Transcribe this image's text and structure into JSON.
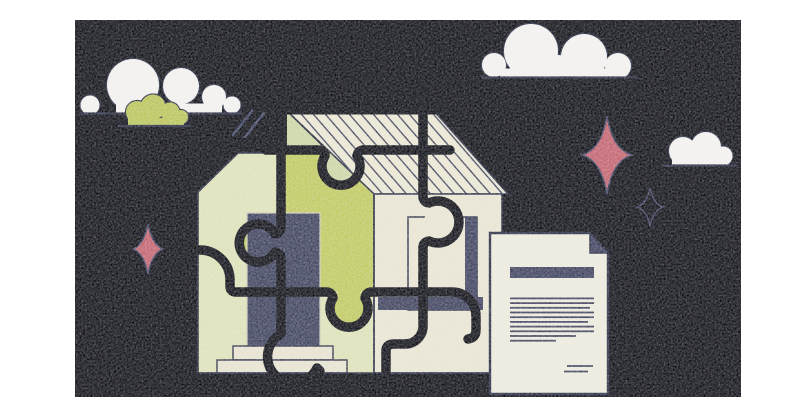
{
  "scene": {
    "description": "Illustration of a house built from interlocking puzzle pieces on a black night background, with clouds, sparkle stars, and a signed paper document",
    "canvas": {
      "x": 75,
      "y": 20,
      "width": 666,
      "height": 377
    }
  },
  "colors": {
    "page_bg": "#ffffff",
    "canvas_bg": "#0b0c11",
    "puzzle_line": "#0b0c12",
    "outline": "#262a40",
    "wall_pale": "#dee2b6",
    "gable_pale": "#cbd6a3",
    "olive": "#bfc95c",
    "roof_cream": "#ebe7d2",
    "wall_cream": "#e9e5d1",
    "hatch_line": "#3f435a",
    "navy": "#3a3e59",
    "step_cream": "#e7e3cf",
    "cloud_white": "#f3f2ee",
    "cloud_olive": "#b9c456",
    "star_red": "#c2606b",
    "star_outline": "#3e4464",
    "paper": "#edebdc",
    "door_edge": "#cfccb8"
  },
  "clouds": [
    {
      "name": "cloud-top-left",
      "color_key": "cloud_white",
      "base": {
        "x1": 80,
        "x2": 242,
        "y": 113.5
      },
      "strip": {
        "x1": 116,
        "x2": 222,
        "h": 10
      },
      "lobes": [
        [
          90,
          105,
          9.5
        ],
        [
          133,
          85,
          26
        ],
        [
          181,
          86,
          18
        ],
        [
          214,
          97,
          12
        ],
        [
          232,
          105,
          8.5
        ]
      ]
    },
    {
      "name": "cloud-olive",
      "color_key": "cloud_olive",
      "base": {
        "x1": 118,
        "x2": 190,
        "y": 126
      },
      "strip": {
        "x1": 128,
        "x2": 184,
        "h": 8
      },
      "lobes": [
        [
          137,
          112,
          11
        ],
        [
          153,
          107,
          12.5
        ],
        [
          170,
          112,
          9.5
        ],
        [
          181,
          117,
          7
        ]
      ]
    },
    {
      "name": "cloud-top-right",
      "color_key": "cloud_white",
      "base": {
        "x1": 482,
        "x2": 637,
        "y": 77.5
      },
      "strip": {
        "x1": 500,
        "x2": 625,
        "h": 9
      },
      "lobes": [
        [
          494,
          65,
          12
        ],
        [
          531,
          51,
          27
        ],
        [
          558,
          68,
          13
        ],
        [
          584,
          57,
          23
        ],
        [
          618,
          66,
          13
        ]
      ]
    },
    {
      "name": "cloud-small-right",
      "color_key": "cloud_white",
      "base": {
        "x1": 663,
        "x2": 737,
        "y": 165.5
      },
      "strip": {
        "x1": 672,
        "x2": 728,
        "h": 8
      },
      "lobes": [
        [
          683,
          151,
          14
        ],
        [
          706,
          147,
          15
        ],
        [
          723,
          156,
          9.5
        ]
      ]
    }
  ],
  "sparkles": [
    {
      "name": "sparkle-red-left",
      "cx": 148,
      "cy": 249,
      "rx": 15,
      "ry": 25,
      "k": 4,
      "fill_key": "star_red",
      "stroke_key": "star_outline"
    },
    {
      "name": "sparkle-red-right",
      "cx": 607,
      "cy": 155,
      "rx": 25,
      "ry": 39,
      "k": 5.5,
      "fill_key": "star_red",
      "stroke_key": "star_outline"
    },
    {
      "name": "sparkle-outline-small",
      "cx": 650,
      "cy": 207,
      "rx": 13,
      "ry": 19,
      "k": 3.2,
      "fill_key": "canvas_bg",
      "stroke_key": "star_outline"
    }
  ],
  "speed_lines": [
    [
      233,
      135,
      252,
      111
    ],
    [
      245,
      137,
      264,
      113
    ]
  ],
  "house": {
    "roof_hatch": {
      "start_x": 296,
      "spacing": 12,
      "count": 19,
      "top_y": 108,
      "dx": 78,
      "bottom_y": 198
    }
  },
  "document": {
    "title_bar": {
      "x": 510,
      "y": 267,
      "w": 84,
      "h": 11
    },
    "text_lines": {
      "x": 510,
      "y_start": 297.5,
      "gap": 4.7,
      "thickness": 1.8,
      "widths": [
        84,
        84,
        80,
        84,
        84,
        78,
        84,
        84,
        66,
        46
      ]
    },
    "signature_lines": [
      [
        567,
        366,
        593
      ],
      [
        564,
        371.5,
        588
      ]
    ]
  }
}
